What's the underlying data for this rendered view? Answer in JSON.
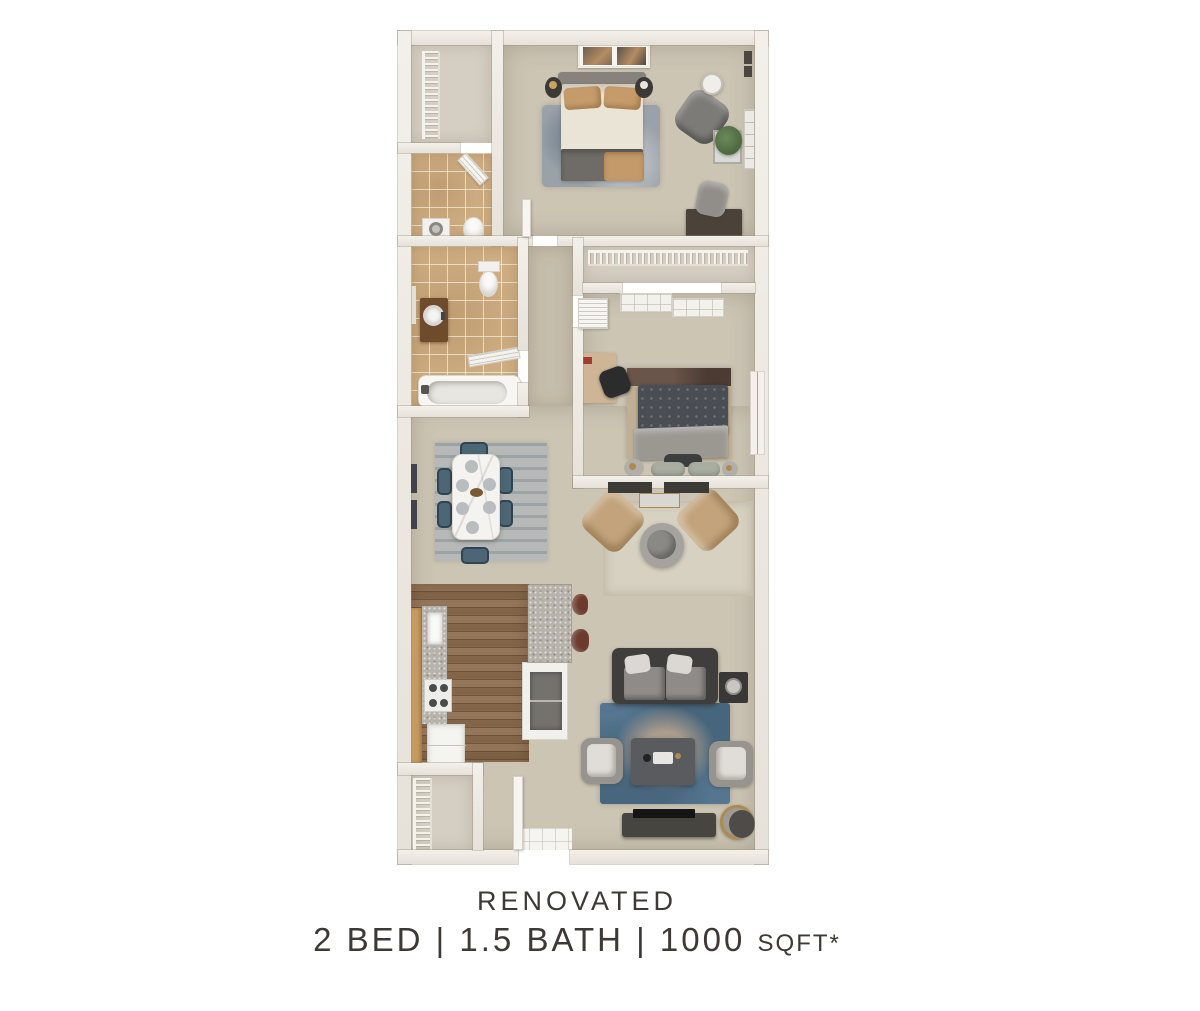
{
  "caption": {
    "line1": "RENOVATED",
    "line2_main": "2 BED | 1.5 BATH | 1000",
    "line2_suffix": "SQFT*"
  },
  "palette": {
    "page-bg": "#ffffff",
    "wall-light": "#f3f0ea",
    "wall-dark": "#e6e1d9",
    "carpet": "#ccc5b4",
    "carpet-light": "#d5cfc3",
    "carpet-hall": "#c6beac",
    "tile": "#cfae83",
    "wood": "#8b6e51",
    "granite": "#b7b3ab",
    "oak": "#c69b61",
    "marble": "#f5f3ef",
    "chair-blue": "#4c6676",
    "rug-dining": "#b6b9b7",
    "rug-nook": "#d7d1c2",
    "rug-blue": "#557590",
    "rug2": "#c1af95",
    "sofa": "#403e3c",
    "accent-tan": "#c2a37b",
    "gold": "#ad8a52",
    "text": "#3c3936"
  }
}
